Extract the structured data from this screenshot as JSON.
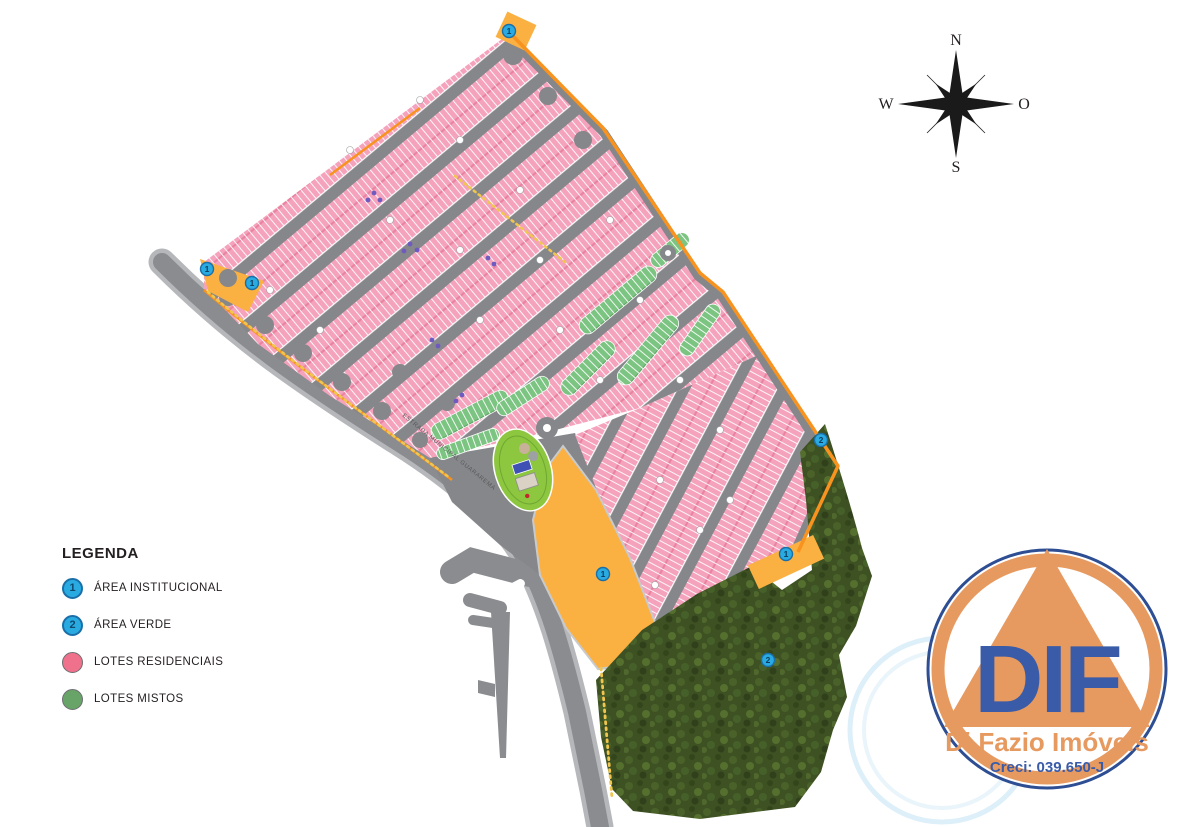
{
  "legend": {
    "title": "LEGENDA",
    "items": [
      {
        "symbol": "1",
        "style": "blue",
        "label": "ÁREA INSTITUCIONAL"
      },
      {
        "symbol": "2",
        "style": "blue",
        "label": "ÁREA VERDE"
      },
      {
        "symbol": "",
        "style": "pink",
        "label": "LOTES RESIDENCIAIS"
      },
      {
        "symbol": "",
        "style": "green",
        "label": "LOTES MISTOS"
      }
    ]
  },
  "compass": {
    "north": "N",
    "south": "S",
    "west": "W",
    "east": "O"
  },
  "map": {
    "road_label": "ESTRADA MUNICIPAL GUARAREMA",
    "markers": [
      {
        "label": "1",
        "x": 509,
        "y": 31
      },
      {
        "label": "1",
        "x": 207,
        "y": 269
      },
      {
        "label": "1",
        "x": 252,
        "y": 283
      },
      {
        "label": "1",
        "x": 603,
        "y": 574
      },
      {
        "label": "1",
        "x": 786,
        "y": 554
      },
      {
        "label": "2",
        "x": 821,
        "y": 440
      },
      {
        "label": "2",
        "x": 768,
        "y": 660
      }
    ],
    "colors": {
      "residential_lots": "#F5A3BD",
      "mixed_lots": "#7CC481",
      "institutional_area": "#FBB042",
      "green_area": "#3E5123",
      "road": "#85878A",
      "boundary": "#F7931E",
      "marker": "#29ABE2"
    }
  },
  "logo": {
    "monogram": "DIF",
    "company": "Di Fazio Imóveis",
    "license": "Creci: 039.650-J"
  }
}
